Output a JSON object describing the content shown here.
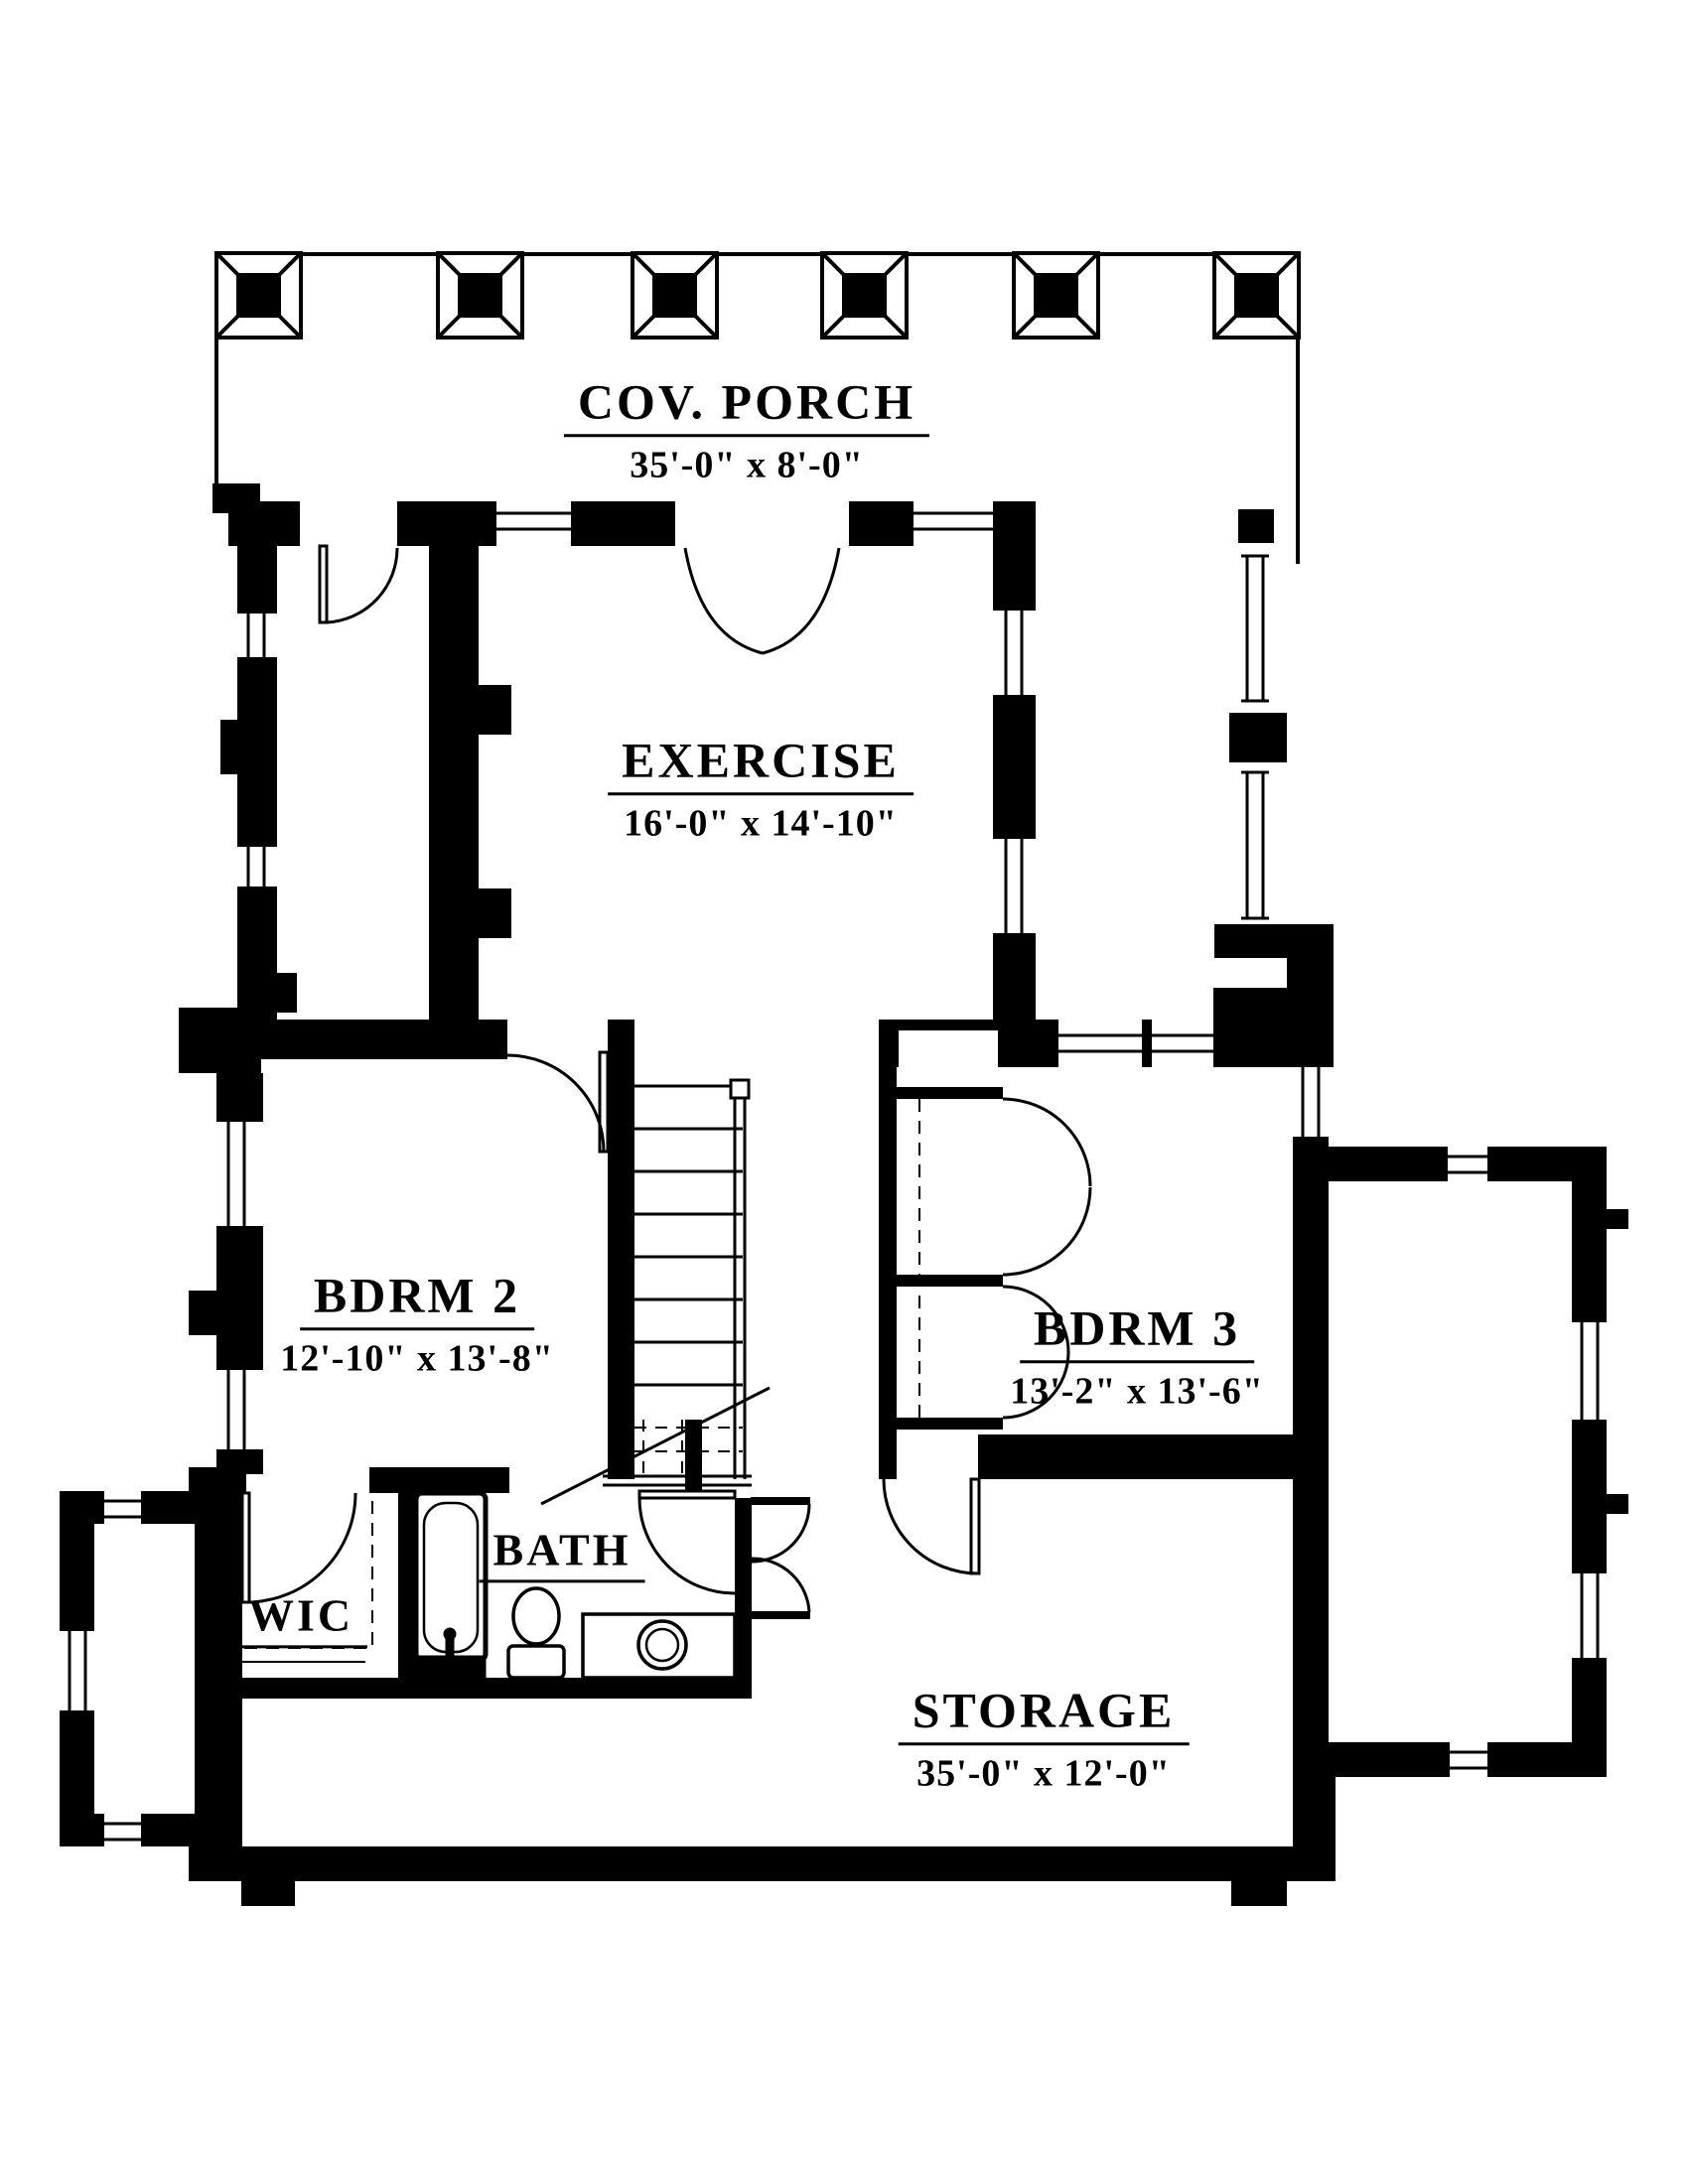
{
  "plan": {
    "title": "Second floor plan",
    "colors": {
      "ink": "#000000",
      "paper": "#ffffff"
    },
    "rooms": [
      {
        "id": "cov-porch",
        "label": "COV. PORCH",
        "dims": "35'-0\" x 8'-0\""
      },
      {
        "id": "exercise",
        "label": "EXERCISE",
        "dims": "16'-0\" x 14'-10\""
      },
      {
        "id": "bdrm2",
        "label": "BDRM 2",
        "dims": "12'-10\" x 13'-8\""
      },
      {
        "id": "bdrm3",
        "label": "BDRM 3",
        "dims": "13'-2\" x 13'-6\""
      },
      {
        "id": "wic",
        "label": "WIC",
        "dims": ""
      },
      {
        "id": "bath",
        "label": "BATH",
        "dims": ""
      },
      {
        "id": "storage",
        "label": "STORAGE",
        "dims": "35'-0\" x 12'-0\""
      }
    ]
  }
}
